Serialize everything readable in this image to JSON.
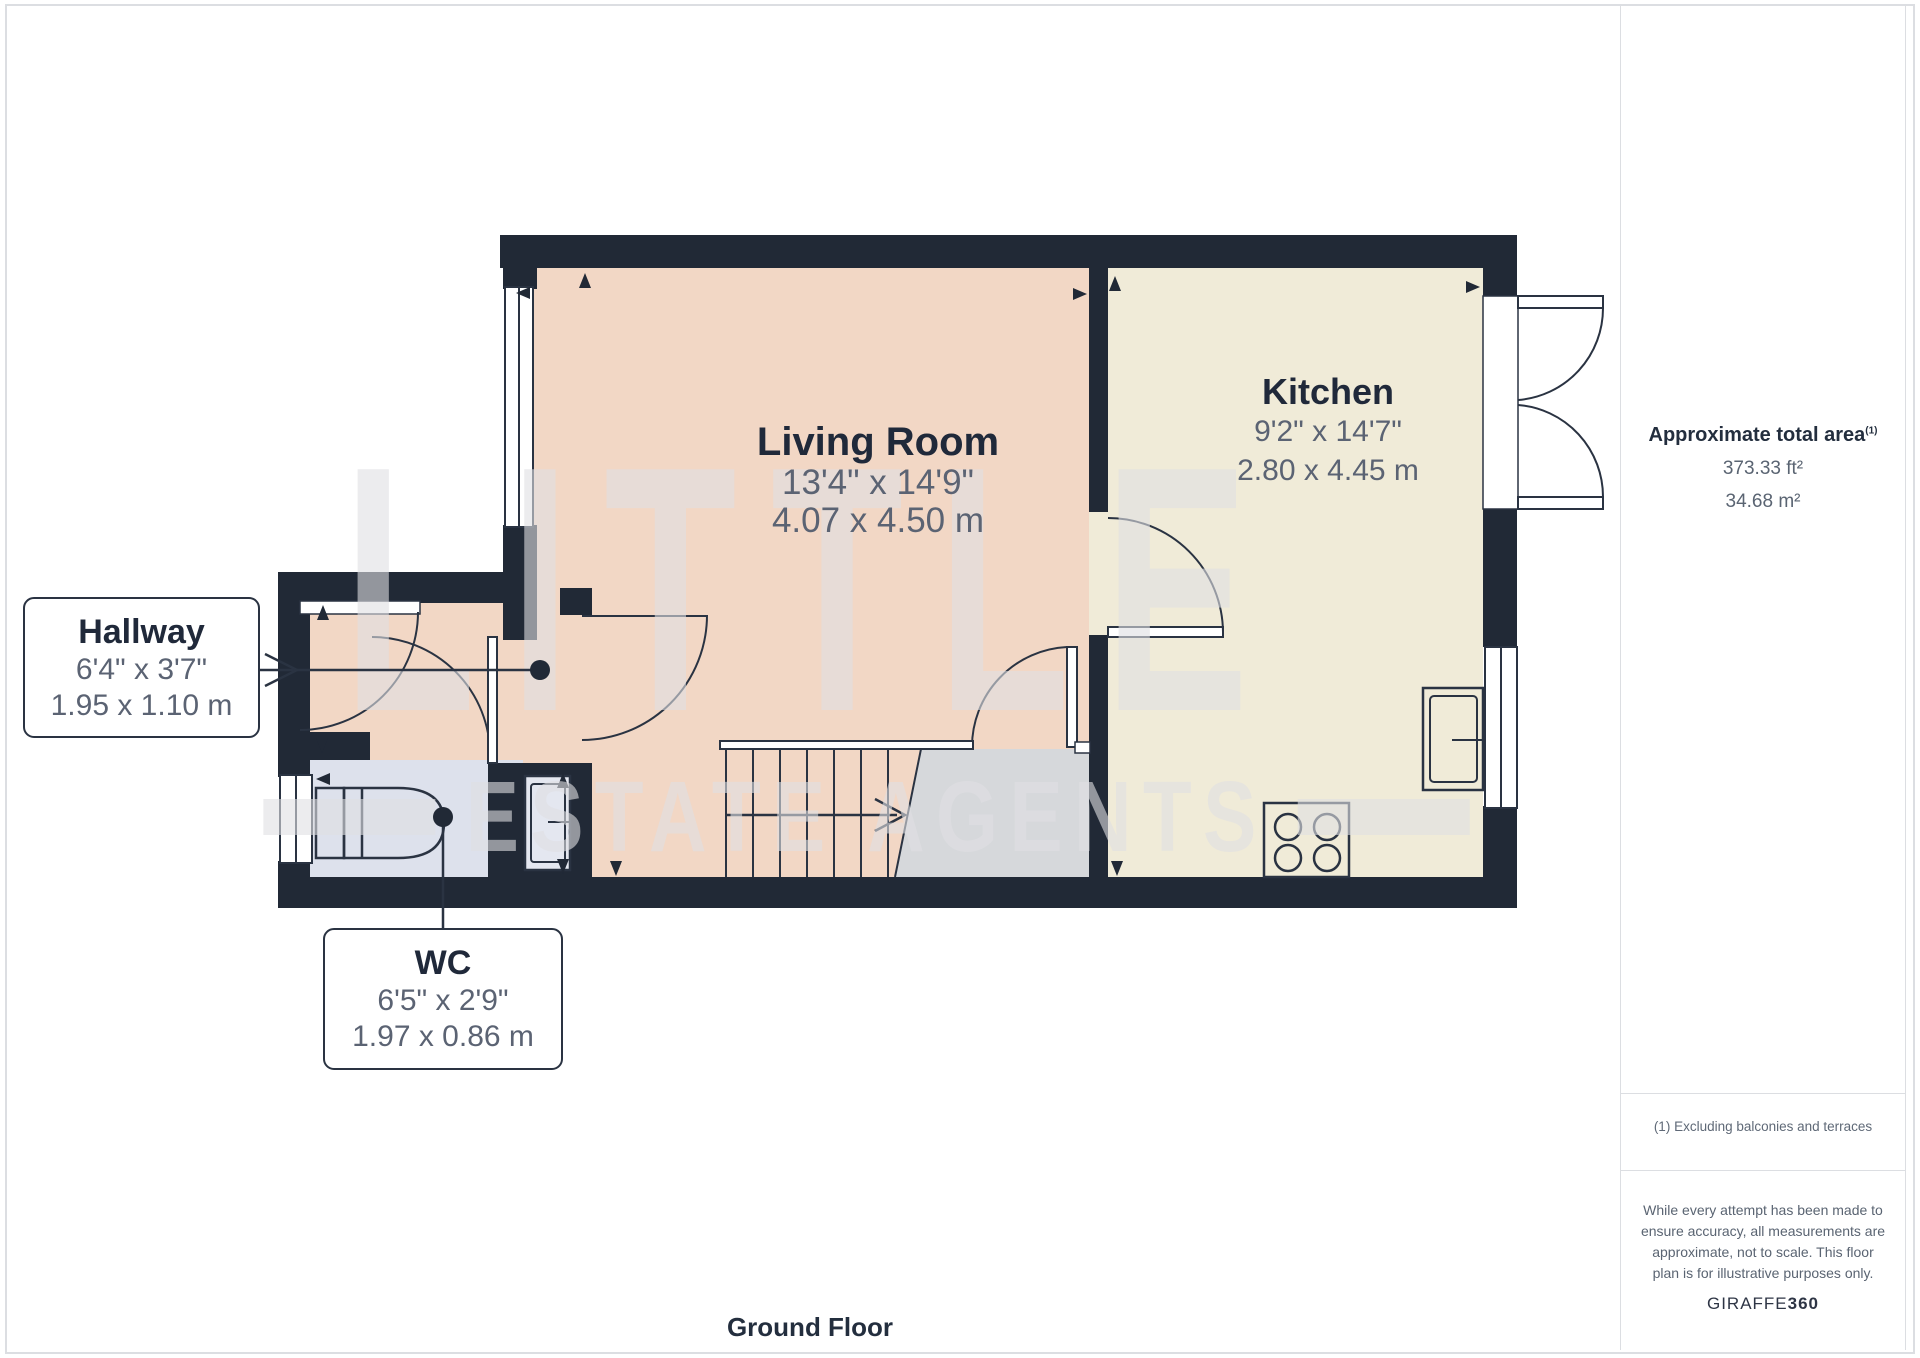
{
  "title": "Ground floor floor plan",
  "rooms": [
    {
      "id": "living_room",
      "name": "Living Room",
      "imperial": "13'4\" x 14'9\"",
      "metric": "4.07 x 4.50 m"
    },
    {
      "id": "kitchen",
      "name": "Kitchen",
      "imperial": "9'2\" x 14'7\"",
      "metric": "2.80 x 4.45 m"
    },
    {
      "id": "hallway",
      "name": "Hallway",
      "imperial": "6'4\" x 3'7\"",
      "metric": "1.95 x 1.10 m"
    },
    {
      "id": "wc",
      "name": "WC",
      "imperial": "6'5\" x 2'9\"",
      "metric": "1.97 x 0.86 m"
    }
  ],
  "sidebar": {
    "area_heading": "Approximate total area",
    "area_superscript": "(1)",
    "area_ft": "373.33 ft²",
    "area_m": "34.68 m²",
    "footnote": "(1) Excluding balconies and terraces",
    "disclaimer_lines": [
      "While every attempt has been made to",
      "ensure accuracy, all measurements are",
      "approximate, not to scale. This floor",
      "plan is for illustrative purposes only."
    ],
    "brand_regular": "GIRAFFE",
    "brand_bold": "360"
  },
  "footer": {
    "floor_label": "Ground Floor"
  },
  "watermark": {
    "line1": "LITTLE",
    "line2": "ESTATE AGENTS"
  },
  "colors": {
    "wall": "#212936",
    "living_floor": "#f2d7c5",
    "kitchen_floor": "#f0ebd8",
    "wc_floor": "#dde1ec",
    "understair": "#d6d8db",
    "label_dark": "#20293a",
    "label_grey": "#5b6373",
    "border_grey": "#dcdee2"
  }
}
